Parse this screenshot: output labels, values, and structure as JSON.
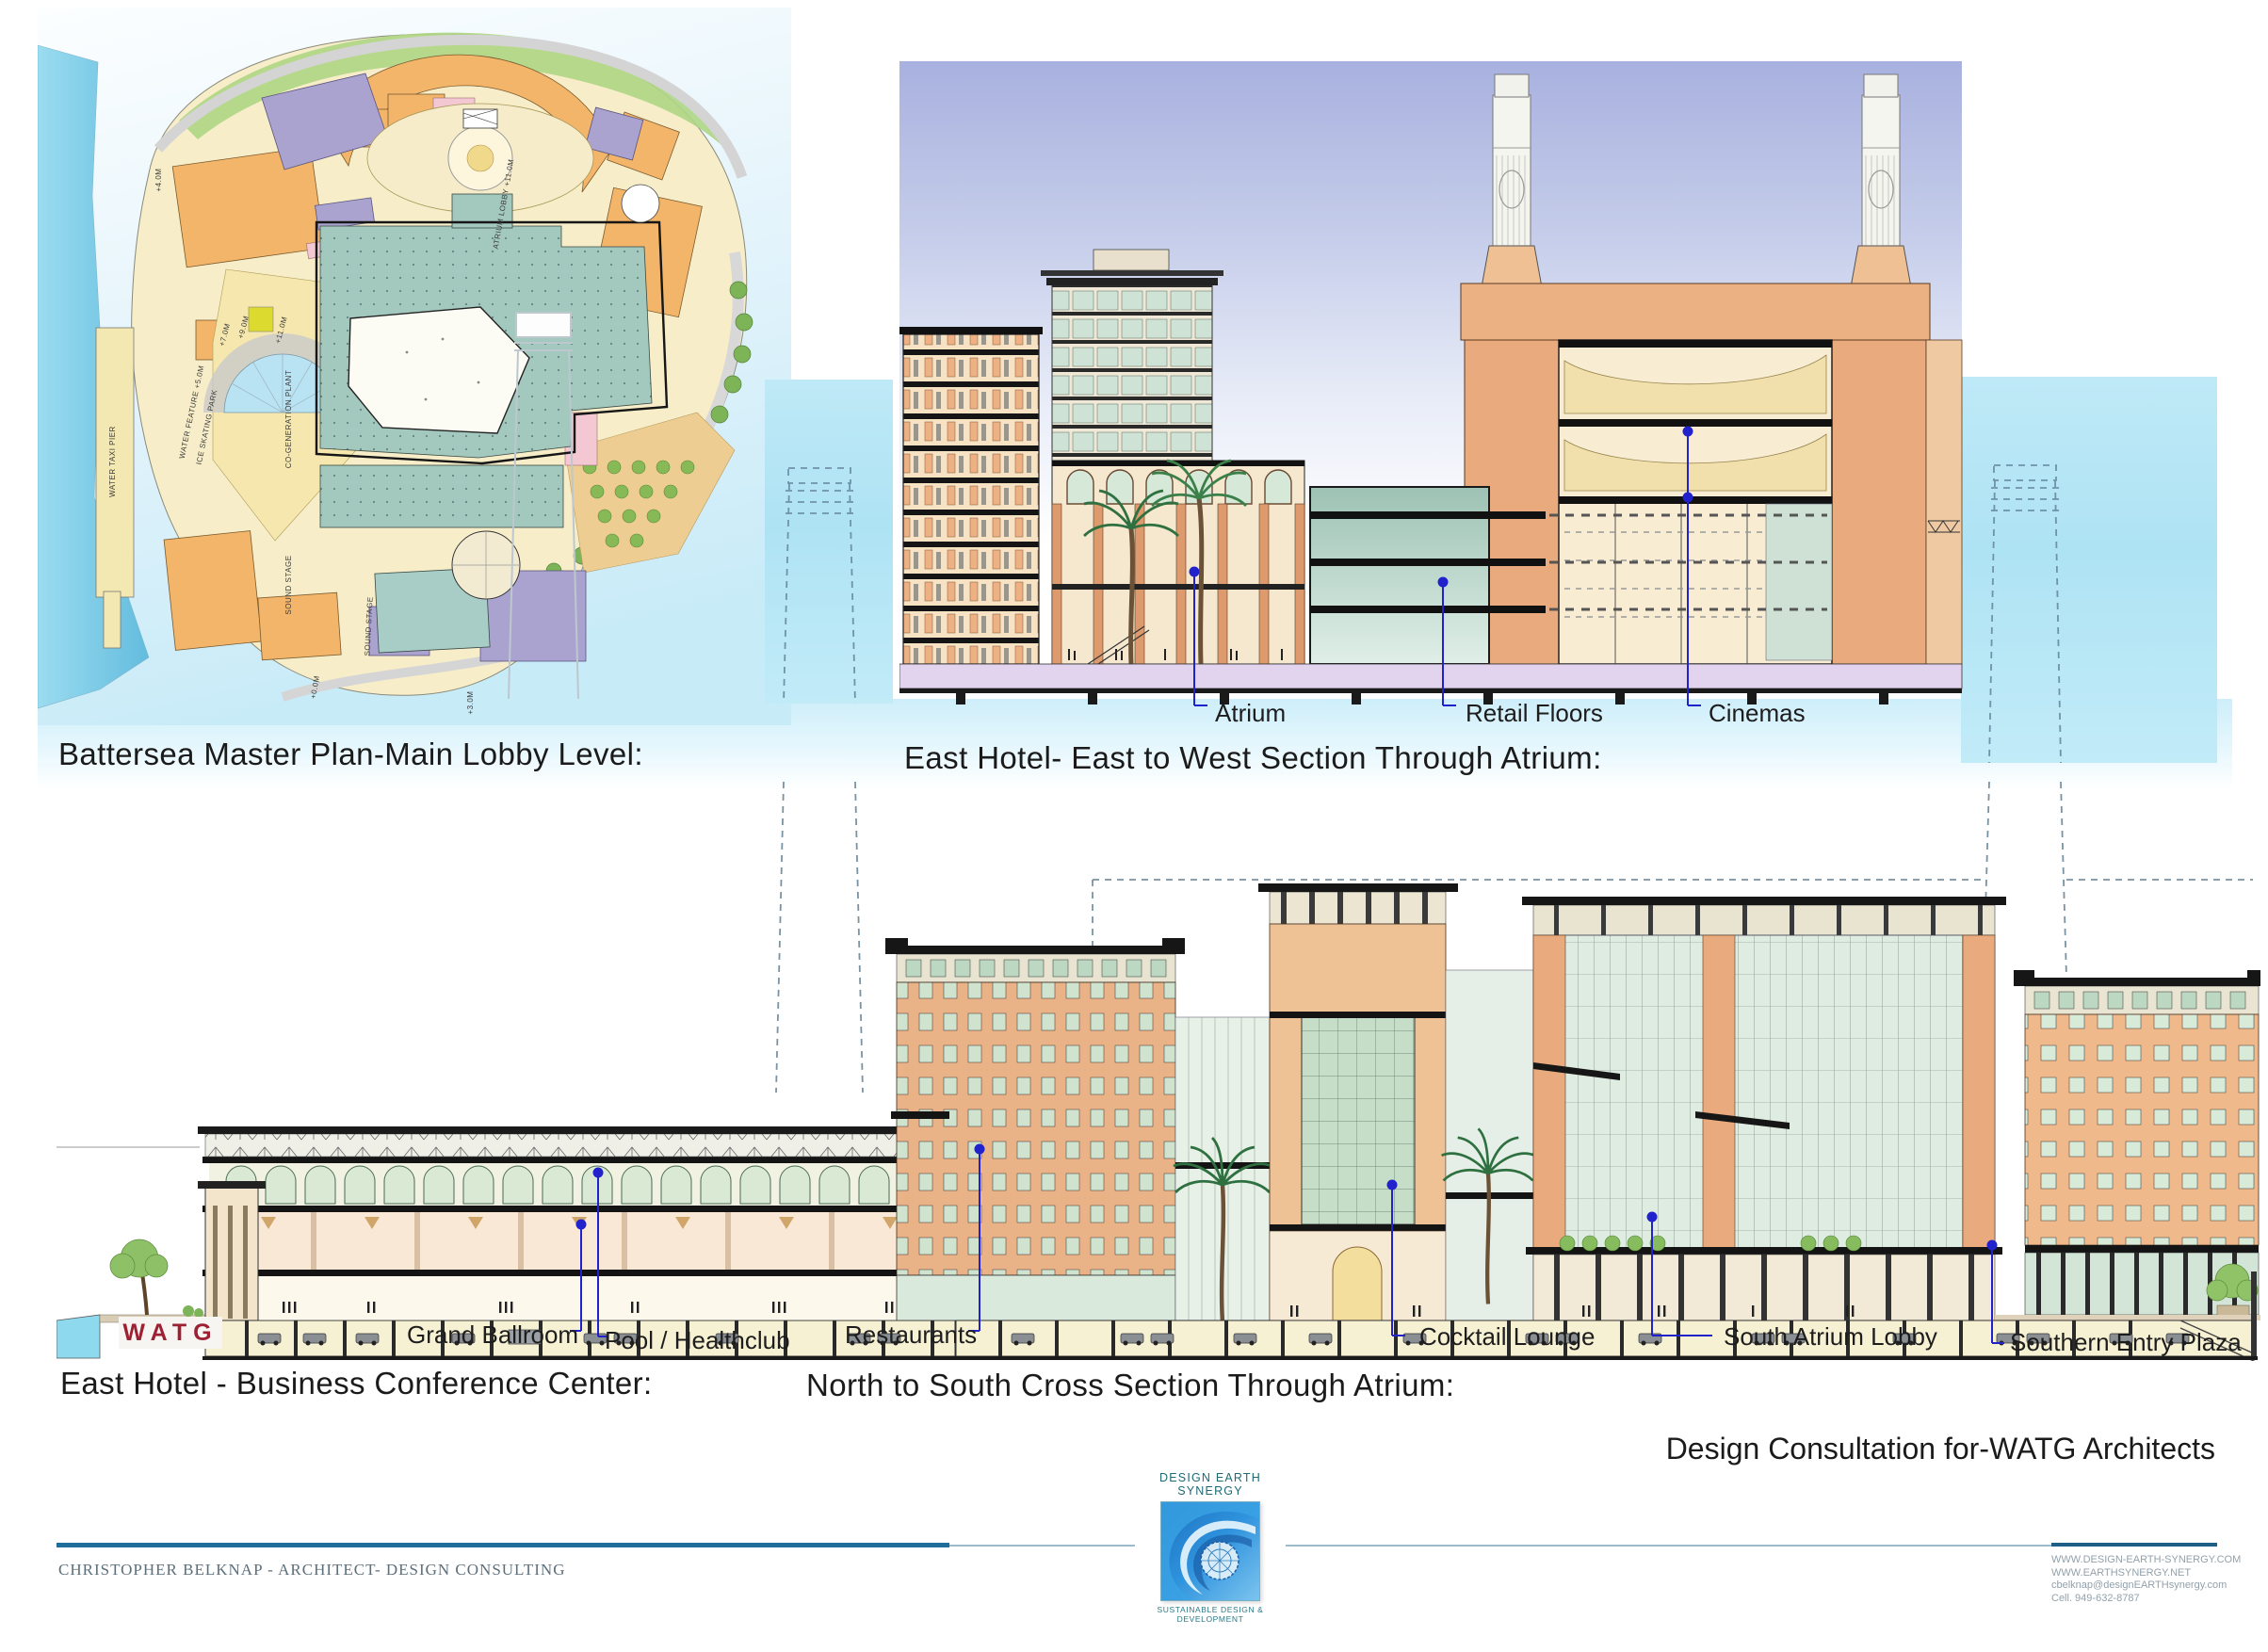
{
  "titles": {
    "master_plan": "Battersea Master Plan-Main Lobby Level:",
    "east_west_section": "East Hotel- East to West Section Through Atrium:",
    "conference_center": "East Hotel - Business Conference Center:",
    "north_south_section": "North to South Cross Section Through Atrium:",
    "consultation_credit": "Design Consultation for-WATG Architects"
  },
  "east_west_labels": {
    "atrium": "Atrium",
    "retail": "Retail Floors",
    "cinemas": "Cinemas"
  },
  "north_south_labels": {
    "grand_ballroom": "Grand Ballroom",
    "pool_healthclub": "Pool / Healthclub",
    "restaurants": "Restaurants",
    "cocktail_lounge": "Cocktail Lounge",
    "south_atrium_lobby": "South Atrium Lobby",
    "southern_entry_plaza": "Southern Entry Plaza"
  },
  "plan": {
    "annotations": [
      "WATER TAXI PIER",
      "ATRIUM LOBBY +11.0M",
      "CO-GENERATION PLANT",
      "WATER FEATURE +5.0M",
      "ICE SKATING PARK",
      "SOUND STAGE",
      "SOUND STAGE",
      "+4.0M",
      "+7.0M",
      "+9.0M",
      "+11.0M",
      "+0.0M",
      "+3.0M"
    ]
  },
  "branding": {
    "watg_logo": "WATG",
    "logo_title": "DESIGN EARTH SYNERGY",
    "logo_tagline": "SUSTAINABLE DESIGN & DEVELOPMENT",
    "credit_line": "CHRISTOPHER BELKNAP - ARCHITECT- DESIGN CONSULTING",
    "contact_lines": [
      "WWW.DESIGN-EARTH-SYNERGY.COM",
      "WWW.EARTHSYNERGY.NET",
      "cbelknap@designEARTHsynergy.com",
      "Cell. 949-632-8787"
    ]
  },
  "colors": {
    "leader_blue": "#2222cc",
    "footer_rule_dark": "#1e6d9a",
    "strip_cyan": "#b5e6f6",
    "brick": "#eab287",
    "retail_teal": "#a3c8bd"
  }
}
